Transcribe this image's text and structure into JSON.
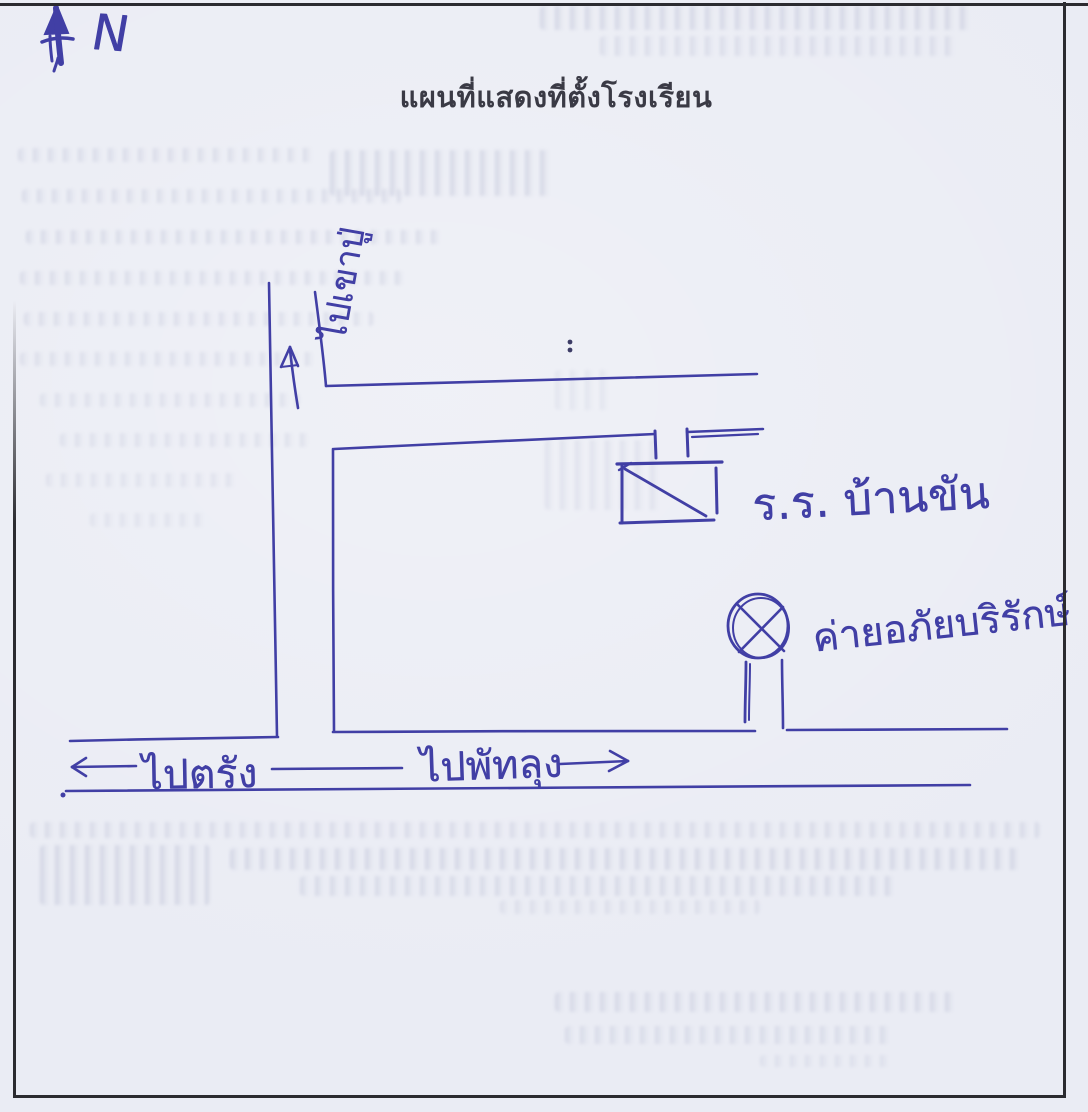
{
  "page": {
    "title": "แผนที่แสดงที่ตั้งโรงเรียน"
  },
  "compass": {
    "label": "N"
  },
  "roads": {
    "north_label": "ไปเขาปู่",
    "west_label": "ไปตรัง",
    "east_label": "ไปพัทลุง"
  },
  "places": {
    "school_label": "ร.ร. บ้านขัน",
    "camp_label": "ค่ายอภัยบริรักษ์"
  },
  "colors": {
    "ink": "#413fa5",
    "paper": "#eaecf4",
    "print": "#3a3a45",
    "frame": "#2b2b30"
  }
}
